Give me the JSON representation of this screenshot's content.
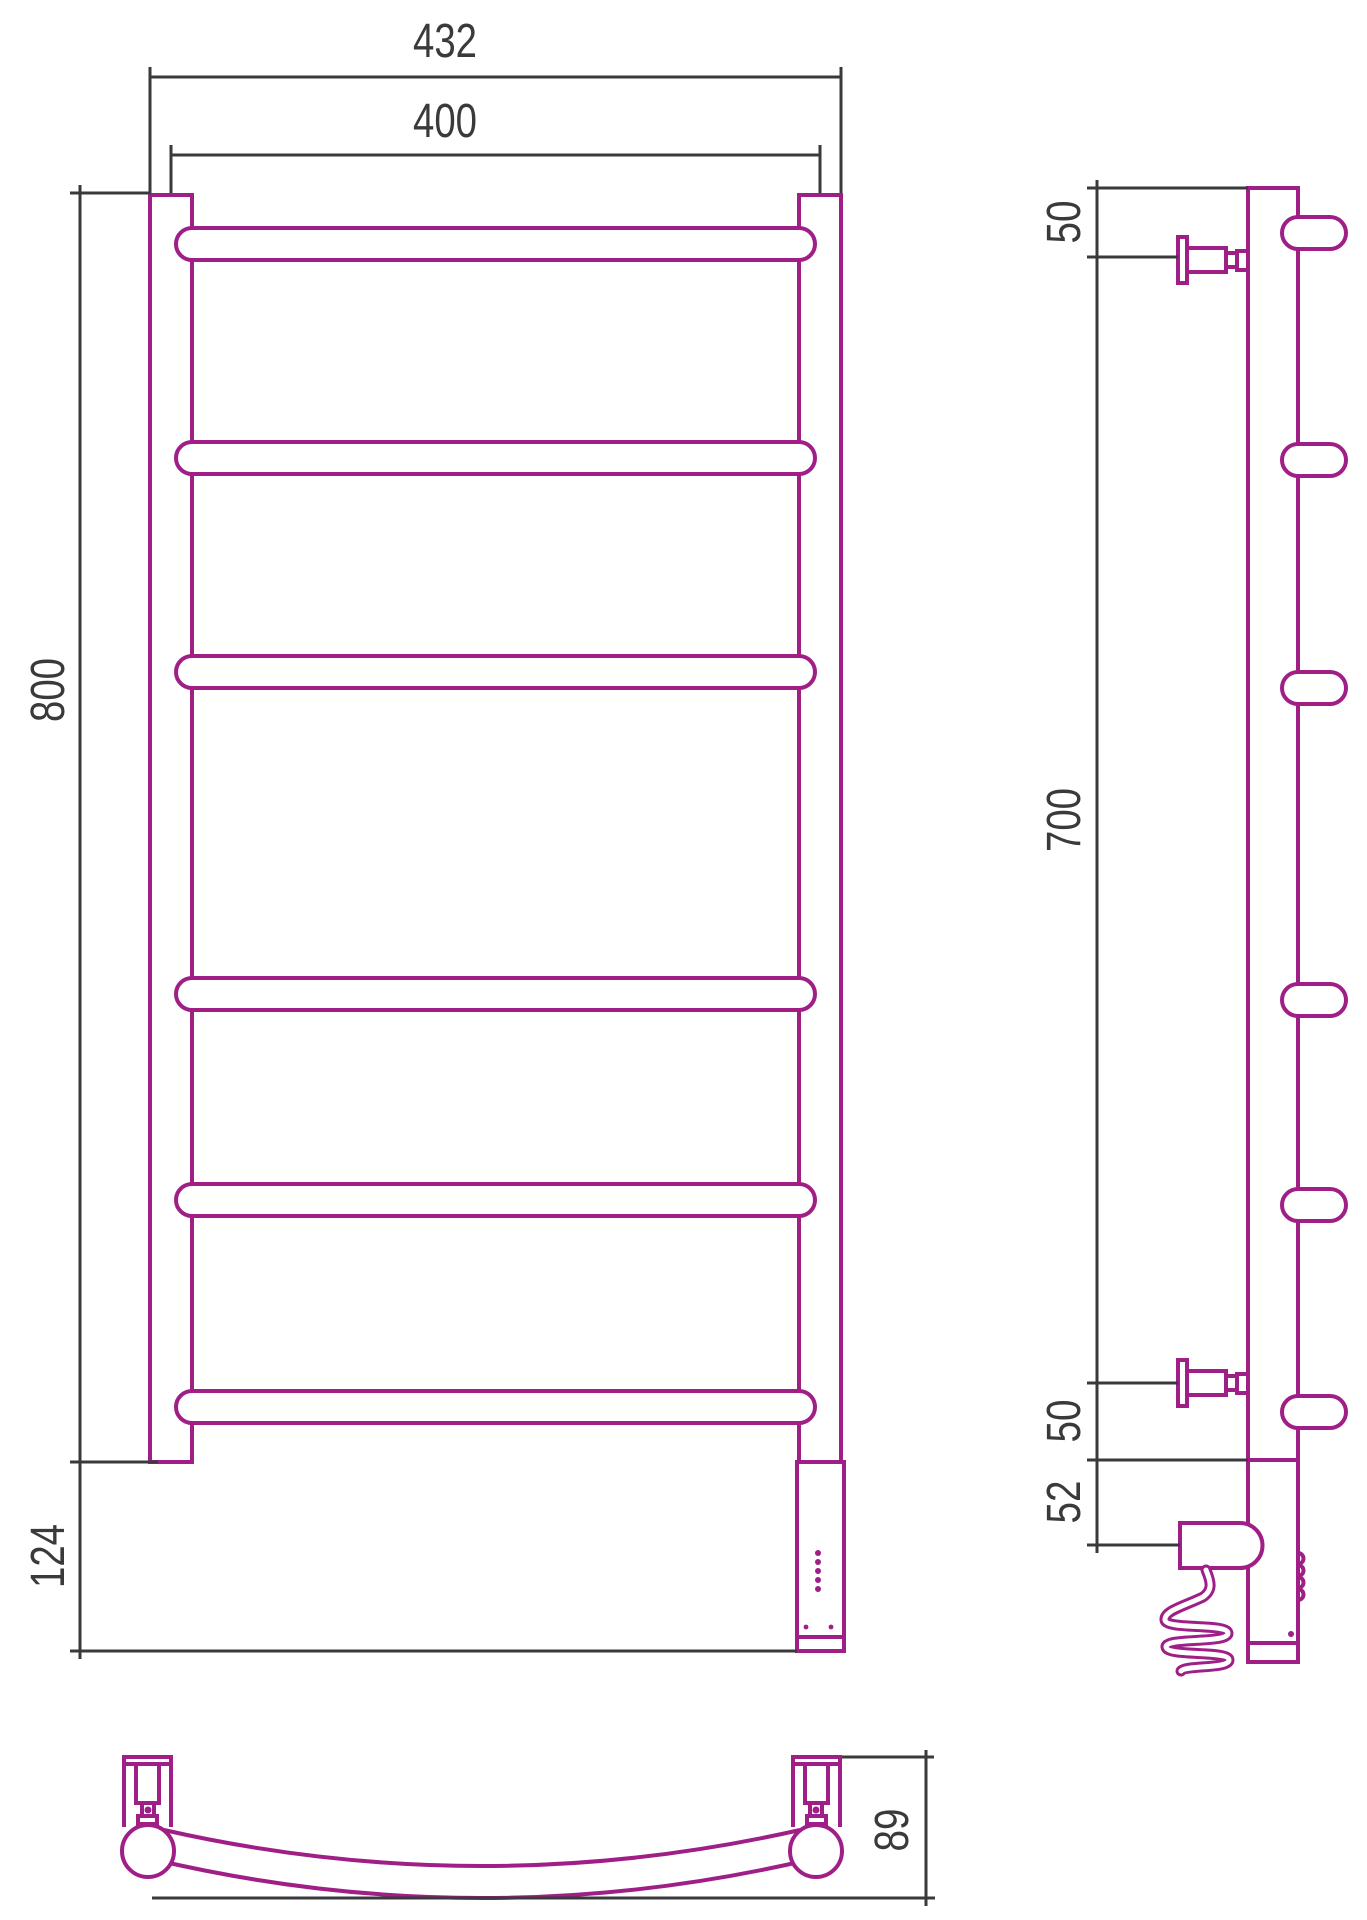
{
  "colors": {
    "product": "#9f1f87",
    "dimension": "#3a3a3c",
    "background": "#ffffff"
  },
  "views": {
    "front": {
      "dims": {
        "overall_width": "432",
        "bar_width": "400",
        "height": "800",
        "lower_section_height": "124"
      }
    },
    "side": {
      "dims": {
        "top_bracket_offset": "50",
        "bracket_span": "700",
        "bottom_bracket_offset": "50",
        "heater_offset": "52"
      }
    },
    "bottom": {
      "dims": {
        "depth": "89"
      }
    }
  }
}
